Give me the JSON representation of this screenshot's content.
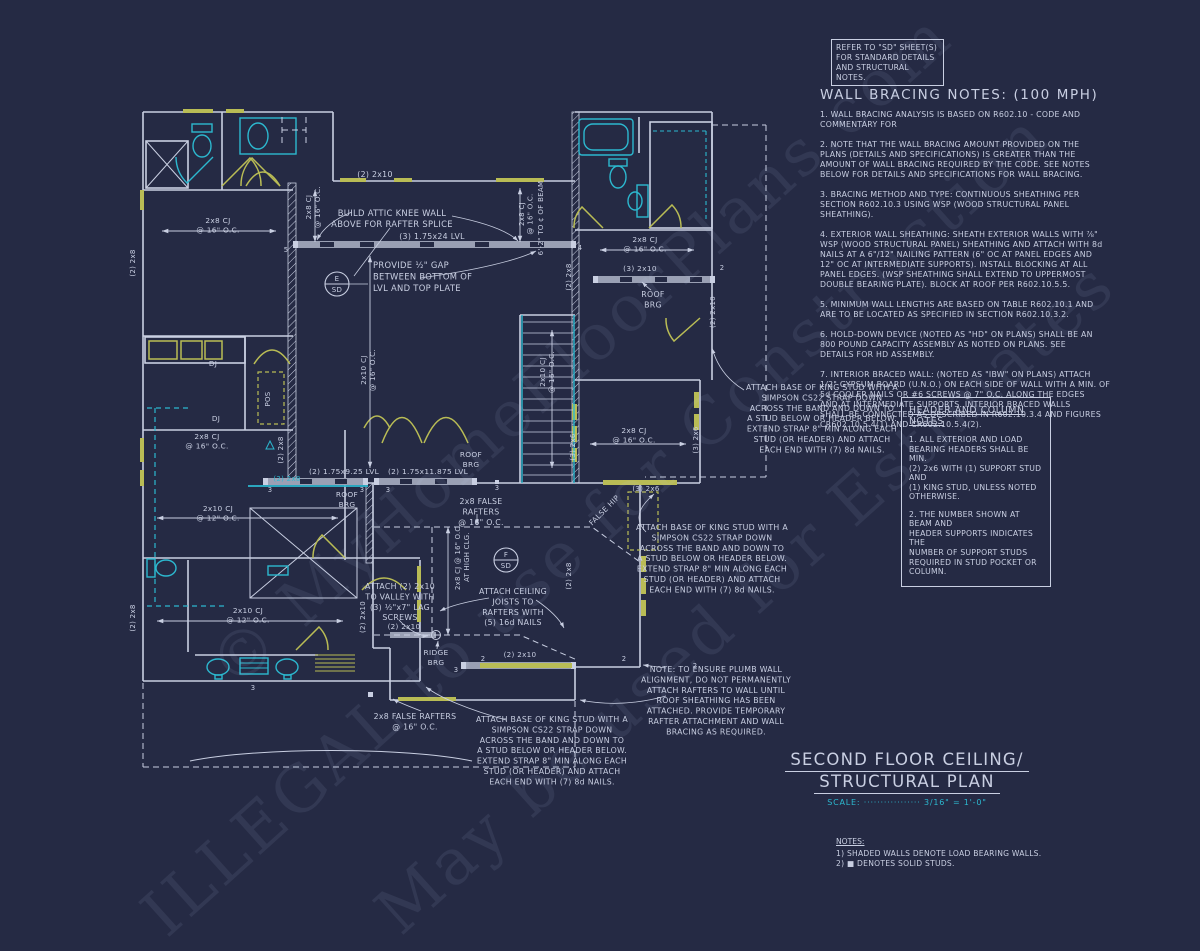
{
  "colors": {
    "background": "#252a44",
    "line": "#c9cfe2",
    "cyan": "#2cb8cf",
    "yellow": "#b9bc55",
    "beam": "#9aa0b4"
  },
  "refer_box": {
    "text": "REFER TO \"SD\" SHEET(S)\nFOR STANDARD DETAILS\nAND STRUCTURAL NOTES."
  },
  "wall_bracing": {
    "title": "WALL BRACING NOTES: (100 MPH)",
    "paragraphs": [
      "1. WALL BRACING ANALYSIS IS BASED ON R602.10 - CODE AND\nCOMMENTARY FOR",
      "2. NOTE THAT THE WALL BRACING AMOUNT PROVIDED ON THE\nPLANS (DETAILS AND SPECIFICATIONS) IS GREATER THAN THE\nAMOUNT OF WALL BRACING REQUIRED BY THE CODE. SEE NOTES\nBELOW FOR DETAILS AND SPECIFICATIONS FOR WALL BRACING.",
      "3. BRACING METHOD AND TYPE: CONTINUOUS SHEATHING PER\nSECTION R602.10.3 USING WSP (WOOD STRUCTURAL PANEL\nSHEATHING).",
      "4. EXTERIOR WALL SHEATHING: SHEATH EXTERIOR WALLS WITH ⅞\"\nWSP (WOOD STRUCTURAL PANEL) SHEATHING AND ATTACH WITH 8d\nNAILS AT A 6\"/12\" NAILING PATTERN (6\" OC AT PANEL EDGES AND\n12\" OC AT INTERMEDIATE SUPPORTS). INSTALL BLOCKING AT ALL\nPANEL EDGES. (WSP SHEATHING SHALL EXTEND TO UPPERMOST\nDOUBLE BEARING PLATE). BLOCK AT ROOF PER R602.10.5.5.",
      "5. MINIMUM WALL LENGTHS ARE BASED ON TABLE R602.10.1 AND\nARE TO BE LOCATED AS SPECIFIED IN SECTION R602.10.3.2.",
      "6. HOLD-DOWN DEVICE (NOTED AS \"HD\" ON PLANS) SHALL BE AN\n800 POUND CAPACITY ASSEMBLY AS NOTED ON PLANS. SEE\nDETAILS FOR HD ASSEMBLY.",
      "7. INTERIOR BRACED WALL: (NOTED AS \"IBW\" ON PLANS) ATTACH\n1/2\" GYPSUM BOARD (U.N.O.) ON EACH SIDE OF WALL WITH A MIN. OF\n5d COOLER NAILS OR #6 SCREWS @ 7\" O.C. ALONG THE EDGES\nAND AT INTERMEDIATE SUPPORTS.  INTERIOR BRACED WALLS\nSHALL BE CONNECTED AS DESCRIBED IN R602.10.3.4 AND FIGURES\nCR602.10.5.4(1) AND CR602.10.5.4(2)."
    ]
  },
  "header_notes": {
    "title": "HEADER AND COLUMN NOTES",
    "paragraphs": [
      "1. ALL EXTERIOR AND LOAD\nBEARING HEADERS SHALL BE MIN.\n(2) 2x6 WITH (1) SUPPORT STUD AND\n(1) KING STUD, UNLESS NOTED\nOTHERWISE.",
      "2. THE NUMBER SHOWN AT BEAM AND\nHEADER SUPPORTS INDICATES THE\nNUMBER OF SUPPORT STUDS\nREQUIRED IN STUD POCKET OR\nCOLUMN."
    ]
  },
  "title_block": {
    "line1": "SECOND FLOOR CEILING/",
    "line2": "STRUCTURAL PLAN",
    "scale_label": "SCALE:",
    "scale_dots": "·················",
    "scale_value": "3/16\" = 1'-0\""
  },
  "notes_block": {
    "title": "NOTES:",
    "items": "1) SHADED WALLS DENOTE LOAD BEARING WALLS.\n2) ■ DENOTES SOLID STUDS."
  },
  "watermark": {
    "line1": "© MyHomeFloorPlans.com",
    "line2": "ILLEGAL to use for Construction",
    "line3": "May be used for Estimates"
  },
  "plan": {
    "labels": [
      {
        "n": "hdr-2x10-top",
        "t": "(2) 2x10",
        "x": 375,
        "y": 177,
        "s": 7.8
      },
      {
        "n": "dim-2x8cj-a",
        "t": [
          "2x8 CJ",
          "@ 16\" O.C."
        ],
        "x": 311,
        "y": 207,
        "r": -90,
        "s": 7.2,
        "lh": 9
      },
      {
        "n": "knee-wall-note",
        "t": [
          "BUILD ATTIC KNEE WALL",
          "ABOVE FOR RAFTER SPLICE"
        ],
        "x": 392,
        "y": 216,
        "s": 8.4,
        "lh": 11
      },
      {
        "n": "lvl-24",
        "t": "(3) 1.75x24 LVL",
        "x": 432,
        "y": 239,
        "s": 7.8
      },
      {
        "n": "gap-note",
        "t": [
          "PROVIDE ½\" GAP",
          "BETWEEN BOTTOM OF",
          "LVL AND TOP PLATE"
        ],
        "x": 373,
        "y": 268,
        "s": 8.4,
        "lh": 11.5,
        "a": "start"
      },
      {
        "n": "circle-e",
        "t": "E",
        "x": 337,
        "y": 281,
        "s": 7
      },
      {
        "n": "circle-e-sd",
        "t": "SD",
        "x": 337,
        "y": 292,
        "s": 7
      },
      {
        "n": "dim-2x10cj-mid",
        "t": [
          "2x10 CJ",
          "@ 16\" O.C."
        ],
        "x": 366,
        "y": 370,
        "r": -90,
        "s": 7.2,
        "lh": 9
      },
      {
        "n": "dim-2x10cj-stairs",
        "t": [
          "2x10 CJ",
          "@ 16\" O.C."
        ],
        "x": 545,
        "y": 372,
        "r": -90,
        "s": 7.2,
        "lh": 9
      },
      {
        "n": "dim-2x8cj-b",
        "t": [
          "2x8 CJ",
          "@ 16\" O.C."
        ],
        "x": 524,
        "y": 214,
        "r": -90,
        "s": 7,
        "lh": 8.5
      },
      {
        "n": "dim-to-beam",
        "t": "6'-2\" TO ¢ OF BEAM",
        "x": 543,
        "y": 218,
        "r": -90,
        "s": 7
      },
      {
        "n": "dim-2x8cj-tr",
        "t": [
          "2x8 CJ",
          "@ 16\" O.C."
        ],
        "x": 645,
        "y": 242,
        "s": 7.4,
        "lh": 9.5
      },
      {
        "n": "hdr-3-2x10",
        "t": "(3) 2x10",
        "x": 640,
        "y": 271,
        "s": 7.4
      },
      {
        "n": "roof-brg-tr",
        "t": [
          "ROOF",
          "BRG"
        ],
        "x": 653,
        "y": 297,
        "s": 7.8,
        "lh": 10.5
      },
      {
        "n": "hdr-2x10-tr-v",
        "t": "(2) 2x10",
        "x": 715,
        "y": 312,
        "r": -90,
        "s": 7
      },
      {
        "n": "dim-2x8cj-mr",
        "t": [
          "2x8 CJ",
          "@ 16\" O.C."
        ],
        "x": 634,
        "y": 433,
        "s": 7.4,
        "lh": 9.5
      },
      {
        "n": "stud-3-2x6-l",
        "t": "(3) 2x6",
        "x": 575,
        "y": 447,
        "r": -90,
        "s": 7
      },
      {
        "n": "stud-3-2x6-r",
        "t": "(3) 2x6",
        "x": 698,
        "y": 440,
        "r": -90,
        "s": 7
      },
      {
        "n": "hdr-3-2x6",
        "t": "(3) 2x6",
        "x": 646,
        "y": 491,
        "s": 7
      },
      {
        "n": "attach-note-1",
        "t": [
          "ATTACH BASE OF KING STUD WITH A",
          "SIMPSON CS22 STRAP DOWN",
          "ACROSS THE BAND AND DOWN TO",
          "A STUD BELOW OR HEADER BELOW.",
          "EXTEND STRAP 8\" MIN ALONG EACH",
          "STUD (OR HEADER) AND ATTACH",
          "EACH END WITH (7) 8d NAILS."
        ],
        "x": 822,
        "y": 390,
        "s": 7.8,
        "lh": 10.4
      },
      {
        "n": "attach-note-2",
        "t": [
          "ATTACH BASE OF KING STUD WITH A",
          "SIMPSON CS22 STRAP DOWN",
          "ACROSS THE BAND AND DOWN TO",
          "A STUD BELOW OR HEADER BELOW.",
          "EXTEND STRAP 8\" MIN ALONG EACH",
          "STUD (OR HEADER) AND ATTACH",
          "EACH END WITH (7) 8d NAILS."
        ],
        "x": 712,
        "y": 530,
        "s": 7.8,
        "lh": 10.4
      },
      {
        "n": "attach-note-3",
        "t": [
          "ATTACH BASE OF KING STUD WITH A",
          "SIMPSON CS22 STRAP DOWN",
          "ACROSS THE BAND AND DOWN TO",
          "A STUD BELOW OR HEADER BELOW.",
          "EXTEND STRAP 8\" MIN ALONG EACH",
          "STUD (OR HEADER) AND ATTACH",
          "EACH END WITH (7) 8d NAILS."
        ],
        "x": 552,
        "y": 722,
        "s": 7.8,
        "lh": 10.4
      },
      {
        "n": "plumb-note",
        "t": [
          "NOTE: TO ENSURE PLUMB WALL",
          "ALIGNMENT, DO NOT PERMANENTLY",
          "ATTACH RAFTERS TO WALL UNTIL",
          "ROOF SHEATHING HAS BEEN",
          "ATTACHED. PROVIDE TEMPORARY",
          "RAFTER ATTACHMENT AND WALL",
          "BRACING AS REQUIRED."
        ],
        "x": 716,
        "y": 672,
        "s": 7.8,
        "lh": 10.4
      },
      {
        "n": "dim-2x8cj-tl",
        "t": [
          "2x8 CJ",
          "@ 16\" O.C."
        ],
        "x": 218,
        "y": 223,
        "s": 7.4,
        "lh": 9.5
      },
      {
        "n": "stud-2x8-left-top",
        "t": "(2) 2x8",
        "x": 135,
        "y": 263,
        "r": -90,
        "s": 7
      },
      {
        "n": "dj-1",
        "t": "DJ",
        "x": 213,
        "y": 366,
        "s": 7.2
      },
      {
        "n": "dj-2",
        "t": "DJ",
        "x": 216,
        "y": 421,
        "s": 7.2
      },
      {
        "n": "pos",
        "t": "POS",
        "x": 270,
        "y": 399,
        "r": -90,
        "s": 7
      },
      {
        "n": "dim-2x8cj-c",
        "t": [
          "2x8 CJ",
          "@ 16\" O.C."
        ],
        "x": 207,
        "y": 439,
        "s": 7.4,
        "lh": 9.5
      },
      {
        "n": "lvl-925",
        "t": "(2) 1.75x9.25 LVL",
        "x": 344,
        "y": 474,
        "s": 7.4
      },
      {
        "n": "lvl-11875",
        "t": "(2) 1.75x11.875 LVL",
        "x": 428,
        "y": 474,
        "s": 7.4
      },
      {
        "n": "roof-brg-a",
        "t": [
          "ROOF",
          "BRG"
        ],
        "x": 347,
        "y": 497,
        "s": 7.4,
        "lh": 10
      },
      {
        "n": "roof-brg-b",
        "t": [
          "ROOF",
          "BRG"
        ],
        "x": 471,
        "y": 457,
        "s": 7.4,
        "lh": 10
      },
      {
        "n": "flush-2x8",
        "t": "(2) 2x8",
        "x": 287,
        "y": 481,
        "s": 7,
        "c": "cyan"
      },
      {
        "n": "dim-2x10cj-mb",
        "t": [
          "2x10 CJ",
          "@ 12\" O.C."
        ],
        "x": 218,
        "y": 511,
        "s": 7.4,
        "lh": 9.5
      },
      {
        "n": "stud-2x8-left-bot",
        "t": "(2) 2x8",
        "x": 135,
        "y": 618,
        "r": -90,
        "s": 7
      },
      {
        "n": "dim-2x10cj-bath",
        "t": [
          "2x10 CJ",
          "@ 12\" O.C."
        ],
        "x": 248,
        "y": 613,
        "s": 7.4,
        "lh": 9.5
      },
      {
        "n": "valley-note",
        "t": [
          "ATTACH (2) 2x10",
          "TO VALLEY WITH",
          "(3) ½\"x7\" LAG",
          "SCREWS"
        ],
        "x": 400,
        "y": 589,
        "s": 7.8,
        "lh": 10.4
      },
      {
        "n": "hdr-2x10-ridge",
        "t": "(2) 2x10",
        "x": 404,
        "y": 629,
        "s": 7.2
      },
      {
        "n": "ridge-brg",
        "t": [
          "RIDGE",
          "BRG"
        ],
        "x": 436,
        "y": 655,
        "s": 7.4,
        "lh": 10
      },
      {
        "n": "false-rafters-1",
        "t": [
          "2x8 FALSE",
          "RAFTERS",
          "@ 16\" O.C."
        ],
        "x": 481,
        "y": 504,
        "s": 7.8,
        "lh": 10.4
      },
      {
        "n": "false-rafters-2",
        "t": [
          "2x8 FALSE RAFTERS",
          "@ 16\" O.C."
        ],
        "x": 415,
        "y": 719,
        "s": 7.8,
        "lh": 10.4
      },
      {
        "n": "false-hip",
        "t": "FALSE HIP",
        "x": 606,
        "y": 512,
        "r": -45,
        "s": 7.4
      },
      {
        "n": "circle-f",
        "t": "F",
        "x": 506,
        "y": 557,
        "s": 7
      },
      {
        "n": "circle-f-sd",
        "t": "SD",
        "x": 506,
        "y": 568,
        "s": 7
      },
      {
        "n": "dim-highclg",
        "t": [
          "2x8 CJ @ 16\" O.C.",
          "AT HIGH CLG."
        ],
        "x": 460,
        "y": 557,
        "r": -90,
        "s": 6.8,
        "lh": 9
      },
      {
        "n": "cj-attach-note",
        "t": [
          "ATTACH CEILING",
          "JOISTS TO",
          "RAFTERS WITH",
          "(5) 16d NAILS"
        ],
        "x": 513,
        "y": 594,
        "s": 7.8,
        "lh": 10.4
      },
      {
        "n": "hdr-2x10-bot",
        "t": "(2) 2x10",
        "x": 520,
        "y": 657,
        "s": 7.2
      },
      {
        "n": "v-2x10-left",
        "t": "(2) 2x10",
        "x": 365,
        "y": 617,
        "r": -90,
        "s": 7
      },
      {
        "n": "v-2x8-stairs",
        "t": "(2) 2x8",
        "x": 571,
        "y": 277,
        "r": -90,
        "s": 7
      },
      {
        "n": "v-2x8-hall",
        "t": "(2) 2x8",
        "x": 283,
        "y": 450,
        "r": -90,
        "s": 7
      },
      {
        "n": "v-2x8-low",
        "t": "(2) 2x8",
        "x": 571,
        "y": 576,
        "r": -90,
        "s": 7
      },
      {
        "n": "tick-5",
        "t": "5",
        "x": 286,
        "y": 252,
        "s": 6.8
      },
      {
        "n": "tick-4",
        "t": "4",
        "x": 580,
        "y": 250,
        "s": 6.8
      },
      {
        "n": "tick-3a",
        "t": "3",
        "x": 270,
        "y": 492,
        "s": 6.8
      },
      {
        "n": "tick-3b",
        "t": "3",
        "x": 362,
        "y": 492,
        "s": 6.8
      },
      {
        "n": "tick-3c",
        "t": "3",
        "x": 388,
        "y": 492,
        "s": 6.8
      },
      {
        "n": "tick-3d",
        "t": "3",
        "x": 497,
        "y": 490,
        "s": 6.8
      },
      {
        "n": "tick-2a",
        "t": "2",
        "x": 722,
        "y": 270,
        "s": 6.8
      },
      {
        "n": "tick-3e",
        "t": "3",
        "x": 456,
        "y": 672,
        "s": 6.8
      },
      {
        "n": "tick-2b",
        "t": "2",
        "x": 483,
        "y": 661,
        "s": 6.8
      },
      {
        "n": "tick-2c",
        "t": "2",
        "x": 624,
        "y": 661,
        "s": 6.8
      },
      {
        "n": "tick-2d",
        "t": "2",
        "x": 695,
        "y": 668,
        "s": 6.8
      },
      {
        "n": "tick-3f",
        "t": "3",
        "x": 253,
        "y": 690,
        "s": 6.8
      }
    ]
  }
}
